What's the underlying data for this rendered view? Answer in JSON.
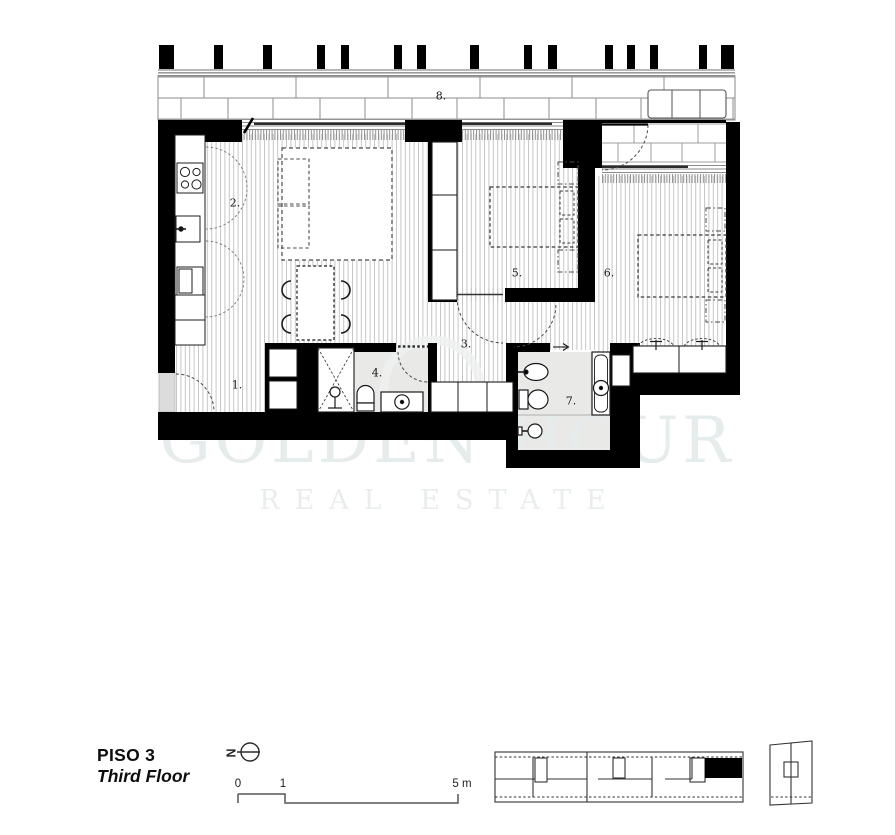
{
  "watermark": {
    "line1": "GOLDEN HOUR",
    "line2": "REAL ESTATE"
  },
  "footer": {
    "floor_label_pt": "PISO 3",
    "floor_label_en": "Third Floor"
  },
  "north": {
    "letter": "N"
  },
  "scale_bar": {
    "tick_zero": "0",
    "tick_one": "1",
    "tick_five": "5 m"
  },
  "rooms": [
    {
      "name": "entrance-hall",
      "label": "1."
    },
    {
      "name": "kitchen-living-room",
      "label": "2."
    },
    {
      "name": "hallway",
      "label": "3."
    },
    {
      "name": "bathroom-1",
      "label": "4."
    },
    {
      "name": "bedroom-1",
      "label": "5."
    },
    {
      "name": "bedroom-2",
      "label": "6."
    },
    {
      "name": "bathroom-2",
      "label": "7."
    },
    {
      "name": "terrace",
      "label": "8."
    }
  ],
  "colors": {
    "wall": "#000000",
    "wood_stripe": "#c6c6c6",
    "bathroom_floor": "#e9e9e8",
    "landing_floor": "#dcdcdc",
    "brick_joint": "#9f9f9f",
    "watermark_text": "#e6ebeb",
    "highlighted_unit": "#000000"
  }
}
